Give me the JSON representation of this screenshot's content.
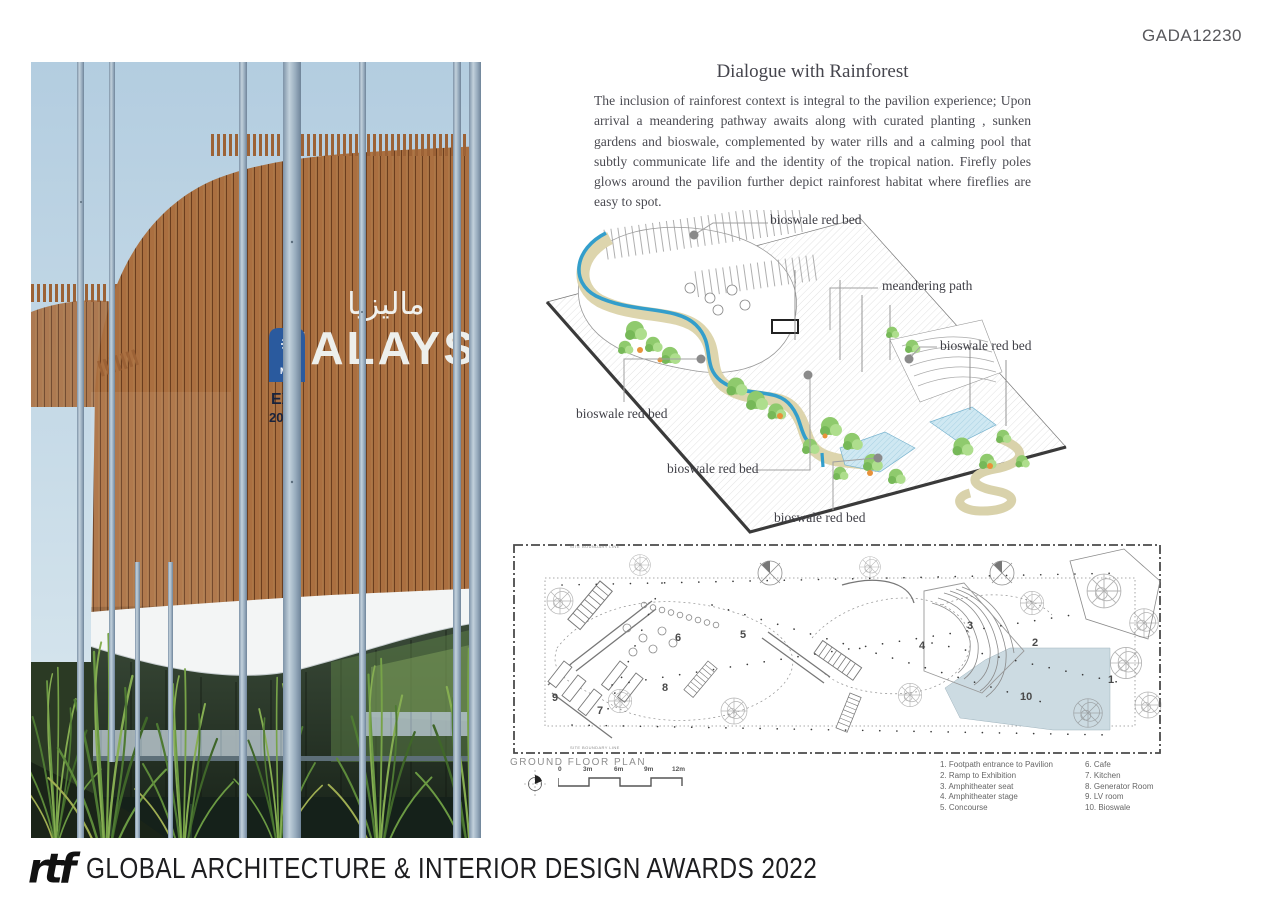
{
  "page": {
    "code": "GADA12230"
  },
  "article": {
    "title": "Dialogue with Rainforest",
    "body": "The inclusion of rainforest context is integral to the pavilion experience; Upon arrival a meandering pathway awaits along with curated planting , sunken gardens and bioswale, complemented by water rills and a calming pool that subtly communicate life and the identity of the tropical nation. Firefly poles glows around the pavilion further depict rainforest habitat where fireflies are easy to spot."
  },
  "photo": {
    "sign_text": "MALAYSIA",
    "sign_arabic": "ماليزيا",
    "banner_line1": "MA",
    "banner_line2": "EX",
    "banner_line3": "202"
  },
  "iso": {
    "labels": [
      "bioswale red bed",
      "meandering path",
      "bioswale red bed",
      "bioswale red bed",
      "bioswale red bed",
      "bioswale red bed"
    ]
  },
  "plan": {
    "title": "GROUND FLOOR PLAN",
    "boundary_label": "SITE BOUNDARY LINE",
    "scale_ticks": [
      "0",
      "3m",
      "6m",
      "9m",
      "12m"
    ],
    "numbers": [
      "1",
      "2",
      "3",
      "4",
      "5",
      "6",
      "7",
      "8",
      "9",
      "10"
    ]
  },
  "legend": {
    "items": [
      "1. Footpath entrance to Pavilion",
      "2. Ramp to Exhibition",
      "3. Amphitheater seat",
      "4. Amphitheater stage",
      "5. Concourse",
      "6. Cafe",
      "7. Kitchen",
      "8. Generator Room",
      "9. LV room",
      "10. Bioswale"
    ]
  },
  "footer": {
    "logo": "rtf",
    "title": "GLOBAL ARCHITECTURE & INTERIOR DESIGN AWARDS 2022"
  },
  "colors": {
    "water_blue": "#339ecb",
    "path_beige": "#ddd5ad",
    "bioswale_fill": "#ccdbe2",
    "timber": "#a96e3f",
    "pole_gray": "#9bb0c2",
    "sky": "#b6d0e1"
  }
}
